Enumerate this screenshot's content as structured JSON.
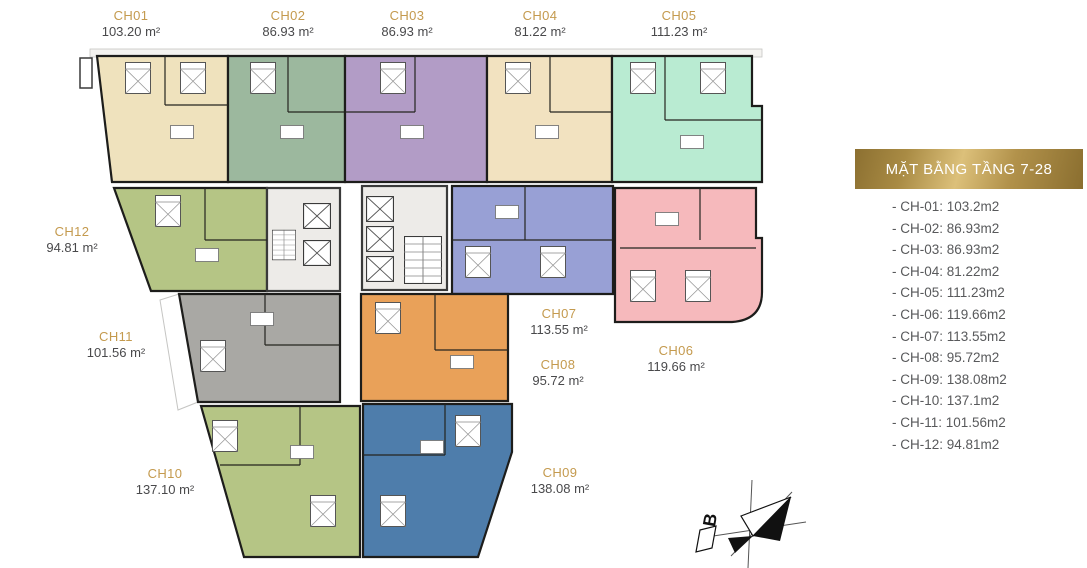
{
  "legend": {
    "title": "MẶT BẰNG TẦNG 7-28",
    "items": [
      "- CH-01: 103.2m2",
      "- CH-02: 86.93m2",
      "- CH-03: 86.93m2",
      "- CH-04: 81.22m2",
      "- CH-05: 111.23m2",
      "- CH-06: 119.66m2",
      "- CH-07: 113.55m2",
      "- CH-08: 95.72m2",
      "- CH-09: 138.08m2",
      "- CH-10: 137.1m2",
      "- CH-11: 101.56m2",
      "- CH-12: 94.81m2"
    ]
  },
  "units": [
    {
      "id": "CH01",
      "label": "CH01",
      "area": "103.20 m²",
      "color": "#efe2bd"
    },
    {
      "id": "CH02",
      "label": "CH02",
      "area": "86.93 m²",
      "color": "#9cb89e"
    },
    {
      "id": "CH03",
      "label": "CH03",
      "area": "86.93 m²",
      "color": "#b29cc6"
    },
    {
      "id": "CH04",
      "label": "CH04",
      "area": "81.22 m²",
      "color": "#f2e2c0"
    },
    {
      "id": "CH05",
      "label": "CH05",
      "area": "111.23 m²",
      "color": "#b9ebd2"
    },
    {
      "id": "CH06",
      "label": "CH06",
      "area": "119.66 m²",
      "color": "#f6b9bc"
    },
    {
      "id": "CH07",
      "label": "CH07",
      "area": "113.55 m²",
      "color": "#98a0d5"
    },
    {
      "id": "CH08",
      "label": "CH08",
      "area": "95.72 m²",
      "color": "#e9a159"
    },
    {
      "id": "CH09",
      "label": "CH09",
      "area": "138.08 m²",
      "color": "#4e7dab"
    },
    {
      "id": "CH10",
      "label": "CH10",
      "area": "137.10 m²",
      "color": "#b5c585"
    },
    {
      "id": "CH11",
      "label": "CH11",
      "area": "101.56 m²",
      "color": "#a9a8a4"
    },
    {
      "id": "CH12",
      "label": "CH12",
      "area": "94.81 m²",
      "color": "#b5c585"
    }
  ],
  "compass": {
    "label": "B"
  },
  "colors": {
    "accent_gold": "#c49a4e",
    "legend_text": "#58595b",
    "area_text": "#49494b",
    "wall": "#1d1d1b",
    "core_fill": "#edebe8"
  }
}
